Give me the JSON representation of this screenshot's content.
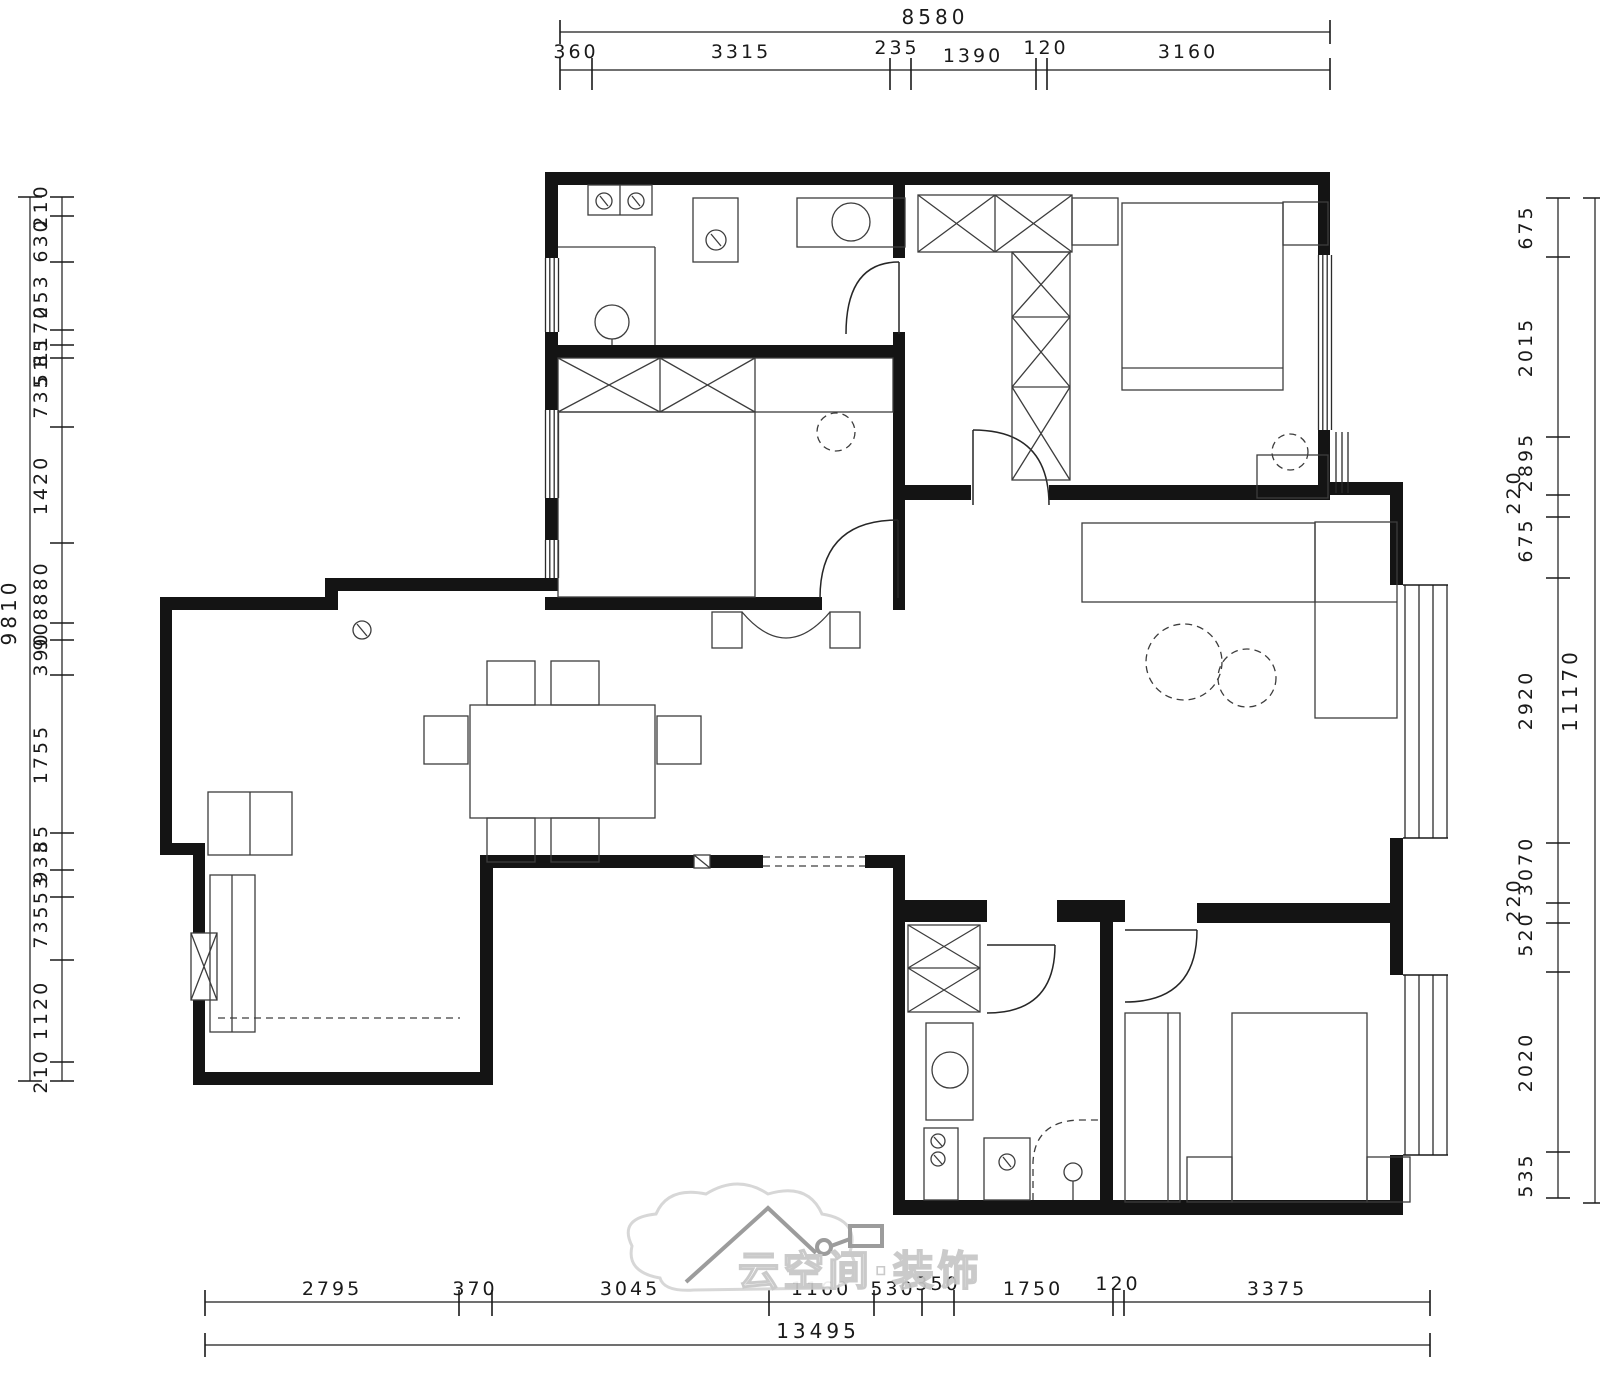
{
  "drawing": {
    "type": "apartment floor plan"
  },
  "watermark": {
    "text": "云空间·装饰"
  },
  "colors": {
    "line": "#1a1a1a",
    "wall": "#141414",
    "furniture": "#3d3d3d",
    "watermark": "#c6c6c6"
  },
  "dims": {
    "top": {
      "total": "8580",
      "values": [
        "360",
        "3315",
        "235",
        "1390",
        "120",
        "3160"
      ]
    },
    "bottom": {
      "total": "13495",
      "values": [
        "2795",
        "370",
        "3045",
        "1160",
        "530",
        "350",
        "1750",
        "120",
        "3375"
      ]
    },
    "left": {
      "total": "9810",
      "values": [
        "210",
        "630",
        "253",
        "1170",
        "85",
        "51",
        "735",
        "1420",
        "880",
        "908",
        "390",
        "1755",
        "85",
        "935",
        "53",
        "735",
        "1120",
        "210"
      ]
    },
    "right": {
      "total": "11170",
      "values": [
        "675",
        "2015",
        "2895",
        "220",
        "675",
        "2920",
        "3070",
        "220",
        "520",
        "2020",
        "535"
      ]
    }
  }
}
